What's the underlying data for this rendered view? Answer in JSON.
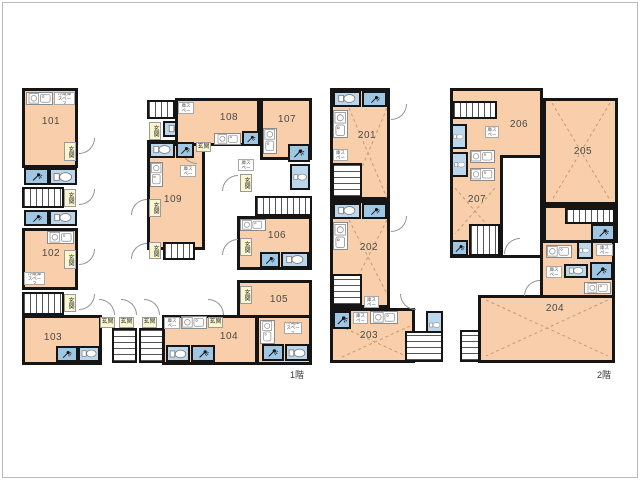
{
  "floors": [
    {
      "label": "1階",
      "rooms": [
        "101",
        "102",
        "103",
        "104",
        "105",
        "106",
        "107",
        "108",
        "109"
      ]
    },
    {
      "label": "2階",
      "rooms": [
        "201",
        "202",
        "203",
        "204",
        "205",
        "206",
        "207"
      ]
    }
  ],
  "labels": {
    "entrance": "玄関",
    "fridge_space": "冷蔵庫スペース"
  },
  "colors": {
    "room_fill": "#f8cfaa",
    "wet_room_fill": "#bcd7ec",
    "shower_room_fill": "#9fc6e2",
    "wall": "#151515",
    "entrance_label_fill": "#faf6cd",
    "frame": "#bababa"
  }
}
